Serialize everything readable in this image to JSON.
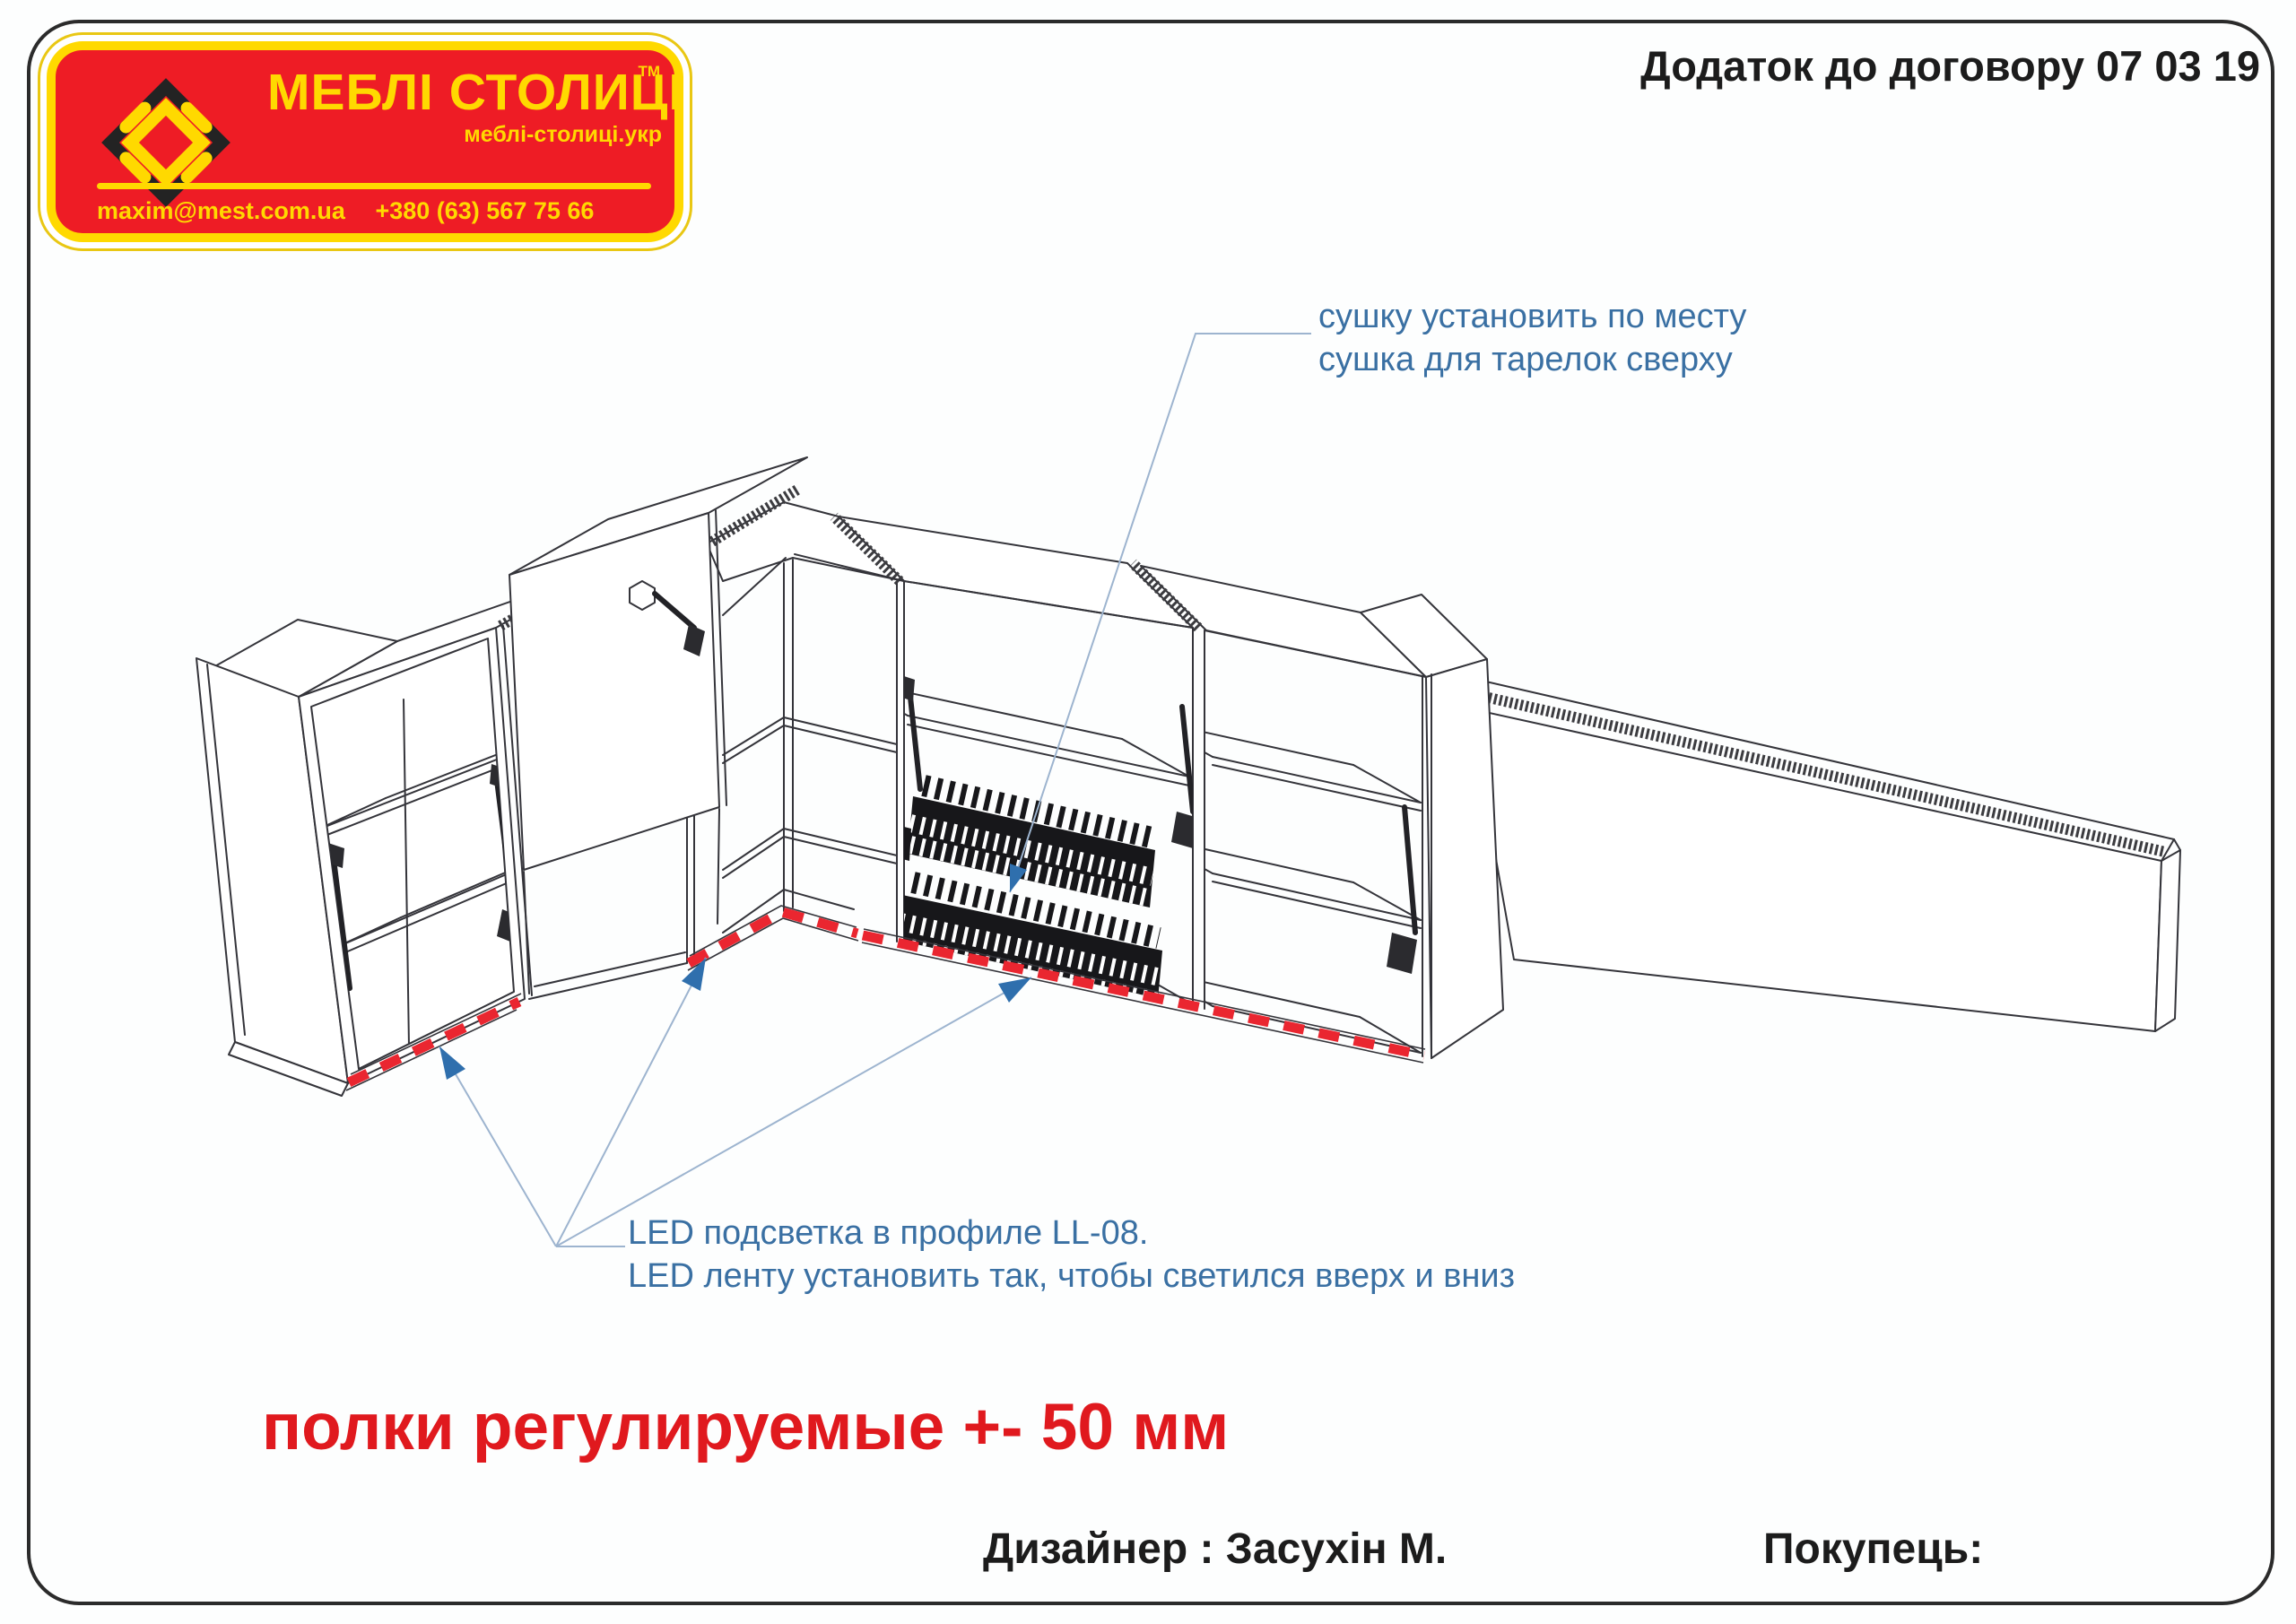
{
  "header": {
    "contract_note": "Додаток до договору 07 03 19"
  },
  "logo": {
    "brand": "МЕБЛІ СТОЛИЦІ",
    "trademark": "TM",
    "website": "меблі-столиці.укр",
    "email": "maxim@mest.com.ua",
    "phone": "+380 (63) 567 75 66",
    "colors": {
      "background": "#ee1c25",
      "accent": "#ffd900"
    }
  },
  "drawing": {
    "dryer_note": {
      "line1": "сушку установить по месту",
      "line2": "сушка для тарелок сверху"
    },
    "led_note": {
      "line1": "LED подсветка в профиле LL-08.",
      "line2": "LED ленту установить так, чтобы светился вверх и вниз"
    },
    "shelves_note": "полки регулируемые +- 50 мм",
    "colors": {
      "annotation": "#3a70a3",
      "warning": "#e0191e",
      "led_strip": "#ea2630",
      "outline": "#34343a"
    }
  },
  "footer": {
    "designer": "Дизайнер : Засухін М.",
    "buyer": "Покупець:"
  }
}
